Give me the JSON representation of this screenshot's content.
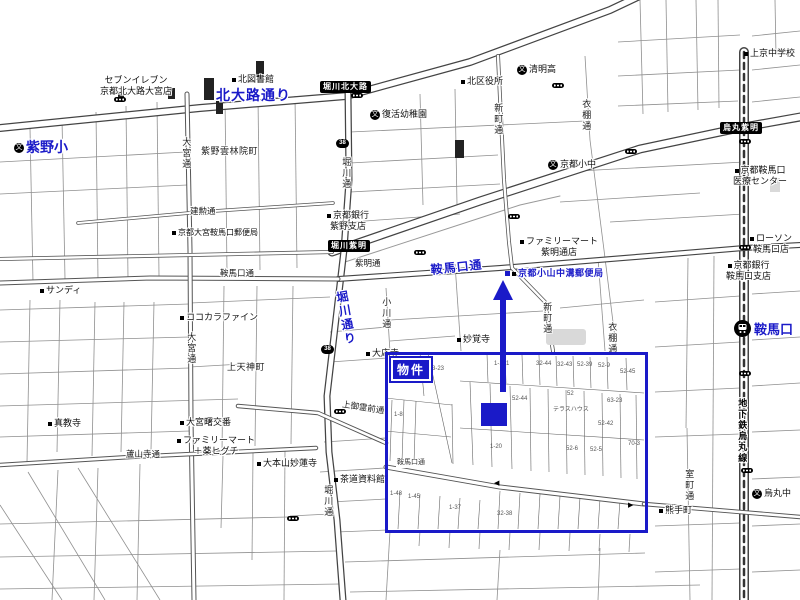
{
  "map": {
    "accent": "#1a1ac8",
    "property": {
      "label": "物件"
    },
    "icon_glyphs": {
      "school": "文"
    },
    "shields": [
      {
        "x": 336,
        "y": 139,
        "label": "38"
      },
      {
        "x": 321,
        "y": 345,
        "label": "38"
      }
    ],
    "signals": [
      [
        114,
        97
      ],
      [
        351,
        93
      ],
      [
        552,
        83
      ],
      [
        625,
        149
      ],
      [
        739,
        139
      ],
      [
        508,
        214
      ],
      [
        414,
        250
      ],
      [
        739,
        245
      ],
      [
        334,
        409
      ],
      [
        739,
        371
      ],
      [
        741,
        468
      ],
      [
        287,
        516
      ]
    ],
    "labels": [
      {
        "id": "kitaoji-dori-label",
        "c": "bstreet",
        "x": 216,
        "y": 87,
        "t": "北大路通り"
      },
      {
        "id": "horikawa-dori-label",
        "c": "bstreet vert",
        "x": 333,
        "y": 292,
        "t": "堀川通り",
        "fs": 12,
        "r": -10
      },
      {
        "id": "kuramaguchi-dori-blue-label",
        "c": "bstreet",
        "x": 430,
        "y": 263,
        "t": "鞍馬口通",
        "fs": 12,
        "r": -6
      },
      {
        "id": "murasakino-elementary-label",
        "c": "bname",
        "x": 14,
        "y": 139,
        "t": "紫野小",
        "i": [
          "school"
        ]
      },
      {
        "id": "kuramaguchi-station-label",
        "c": "bname",
        "x": 754,
        "y": 322,
        "t": "鞍馬口",
        "fs": 13
      },
      {
        "id": "koyama-nakamizo-post-office-label",
        "c": "bpoi",
        "x": 505,
        "y": 268,
        "t": "京都小山中溝郵便局",
        "i": [
          "bluesq",
          "dot"
        ]
      },
      {
        "id": "horikawa-kitaoji-box",
        "c": "ibox",
        "x": 320,
        "y": 81,
        "t": "堀川北大路"
      },
      {
        "id": "horikawa-shimei-box",
        "c": "ibox",
        "x": 328,
        "y": 240,
        "t": "堀川紫明"
      },
      {
        "id": "karasuma-shimei-box",
        "c": "ibox",
        "x": 720,
        "y": 122,
        "t": "烏丸紫明"
      },
      {
        "id": "seven-eleven-label",
        "c": "poi ctr",
        "x": 100,
        "y": 75,
        "t": "セブンイレブン\n京都北大路大宮店"
      },
      {
        "id": "kita-library-label",
        "c": "poi",
        "x": 232,
        "y": 74,
        "t": "北図書館",
        "i": [
          "dot"
        ]
      },
      {
        "id": "fukkatsu-kindergarten-label",
        "c": "poi",
        "x": 370,
        "y": 109,
        "t": "復活幼稚園",
        "i": [
          "school"
        ]
      },
      {
        "id": "kita-ward-office-label",
        "c": "poi",
        "x": 461,
        "y": 76,
        "t": "北区役所",
        "i": [
          "dot"
        ]
      },
      {
        "id": "seimei-high-label",
        "c": "poi",
        "x": 517,
        "y": 64,
        "t": "清明高",
        "i": [
          "school"
        ]
      },
      {
        "id": "murasakino-unrinin-cho-label",
        "c": "town",
        "x": 201,
        "y": 146,
        "t": "紫野雲林院町"
      },
      {
        "id": "kyoto-shochu-label",
        "c": "poi",
        "x": 548,
        "y": 159,
        "t": "京都小中",
        "i": [
          "school"
        ]
      },
      {
        "id": "kamigyo-jhs-label",
        "c": "poi",
        "x": 744,
        "y": 48,
        "t": "上京中学校",
        "i": [
          "dot"
        ]
      },
      {
        "id": "kuramaguchi-medical-center-label",
        "c": "poi ctr",
        "x": 733,
        "y": 165,
        "t": "京都鞍馬口\n医療センター",
        "i": [
          "dot"
        ]
      },
      {
        "id": "lawson-kuramaguchi-label",
        "c": "poi ctr",
        "x": 750,
        "y": 233,
        "t": "ローソン\n鞍馬口店",
        "i": [
          "dot"
        ]
      },
      {
        "id": "kyoto-bank-murasakino-label",
        "c": "poi ctr",
        "x": 327,
        "y": 210,
        "t": "京都銀行\n紫野支店",
        "i": [
          "dot"
        ]
      },
      {
        "id": "kyoto-bank-kuramaguchi-label",
        "c": "poi ctr",
        "x": 726,
        "y": 260,
        "t": "京都銀行\n鞍馬口支店",
        "i": [
          "dot"
        ]
      },
      {
        "id": "familymart-shimei-label",
        "c": "poi ctr",
        "x": 520,
        "y": 236,
        "t": "ファミリーマート\n紫明通店",
        "i": [
          "dot"
        ]
      },
      {
        "id": "kenkun-dori-label",
        "c": "street",
        "x": 190,
        "y": 206,
        "t": "建勲通"
      },
      {
        "id": "omiya-kuramaguchi-post-office-label",
        "c": "poi",
        "x": 172,
        "y": 228,
        "t": "京都大宮鞍馬口郵便局",
        "i": [
          "dot"
        ],
        "fs": 8
      },
      {
        "id": "shimei-dori-label",
        "c": "street",
        "x": 355,
        "y": 258,
        "t": "紫明通"
      },
      {
        "id": "sandy-label",
        "c": "poi",
        "x": 40,
        "y": 285,
        "t": "サンディ",
        "i": [
          "dot"
        ]
      },
      {
        "id": "cocokara-fine-label",
        "c": "poi",
        "x": 180,
        "y": 312,
        "t": "ココカラファイン",
        "i": [
          "dot"
        ]
      },
      {
        "id": "kuramaguchi-dori-west-label",
        "c": "street",
        "x": 220,
        "y": 268,
        "t": "鞍馬口通"
      },
      {
        "id": "kamitenjin-cho-label",
        "c": "town",
        "x": 227,
        "y": 362,
        "t": "上天神町"
      },
      {
        "id": "shinkyoji-label",
        "c": "poi",
        "x": 48,
        "y": 418,
        "t": "真教寺",
        "i": [
          "dot"
        ]
      },
      {
        "id": "omiya-koban-label",
        "c": "poi",
        "x": 180,
        "y": 417,
        "t": "大宮曙交番",
        "i": [
          "dot"
        ]
      },
      {
        "id": "familymart-higuchi-label",
        "c": "poi ctr",
        "x": 177,
        "y": 435,
        "t": "ファミリーマート\n＋薬ヒグチ",
        "i": [
          "dot"
        ]
      },
      {
        "id": "rozanji-dori-label",
        "c": "street",
        "x": 126,
        "y": 449,
        "t": "蘆山寺通"
      },
      {
        "id": "myorenji-label",
        "c": "poi",
        "x": 257,
        "y": 458,
        "t": "大本山妙蓮寺",
        "i": [
          "dot"
        ]
      },
      {
        "id": "kamigoryo-mae-dori-label",
        "c": "street",
        "x": 343,
        "y": 399,
        "t": "上御霊前通",
        "r": 9
      },
      {
        "id": "sado-museum-label",
        "c": "poi",
        "x": 334,
        "y": 474,
        "t": "茶道資料館",
        "i": [
          "dot"
        ]
      },
      {
        "id": "myokakuji-label",
        "c": "poi",
        "x": 457,
        "y": 334,
        "t": "妙覚寺",
        "i": [
          "dot"
        ]
      },
      {
        "id": "daioji-label",
        "c": "poi",
        "x": 366,
        "y": 348,
        "t": "大応寺",
        "i": [
          "dot"
        ]
      },
      {
        "id": "kumade-cho-label",
        "c": "poi",
        "x": 659,
        "y": 505,
        "t": "熊手町",
        "i": [
          "dot"
        ]
      },
      {
        "id": "karasuma-chu-label",
        "c": "poi",
        "x": 752,
        "y": 488,
        "t": "烏丸中",
        "i": [
          "school"
        ]
      },
      {
        "id": "omiya-dori-north-label",
        "c": "vstreet",
        "x": 180,
        "y": 137,
        "t": "大宮通"
      },
      {
        "id": "horikawa-dori-north-label",
        "c": "vstreet",
        "x": 340,
        "y": 157,
        "t": "堀川通"
      },
      {
        "id": "shinmachi-dori-north-label",
        "c": "vstreet",
        "x": 492,
        "y": 103,
        "t": "新町通"
      },
      {
        "id": "koromonotana-dori-north-label",
        "c": "vstreet",
        "x": 580,
        "y": 99,
        "t": "衣棚通"
      },
      {
        "id": "omiya-dori-south-label",
        "c": "vstreet",
        "x": 185,
        "y": 332,
        "t": "大宮通"
      },
      {
        "id": "ogawa-dori-label",
        "c": "vstreet",
        "x": 380,
        "y": 297,
        "t": "小川通"
      },
      {
        "id": "shinmachi-dori-south-label",
        "c": "vstreet",
        "x": 541,
        "y": 302,
        "t": "新町通"
      },
      {
        "id": "koromonotana-dori-south-label",
        "c": "vstreet",
        "x": 606,
        "y": 322,
        "t": "衣棚通"
      },
      {
        "id": "horikawa-dori-south-label",
        "c": "vstreet",
        "x": 322,
        "y": 485,
        "t": "堀川通"
      },
      {
        "id": "muromachi-dori-label",
        "c": "vstreet",
        "x": 683,
        "y": 469,
        "t": "室町通"
      },
      {
        "id": "karasuma-subway-line-label",
        "c": "vstreet dark",
        "x": 736,
        "y": 398,
        "t": "地下鉄烏丸線"
      },
      {
        "id": "kuramaguchi-dori-rect-label",
        "c": "tinystreet",
        "x": 396,
        "y": 459,
        "t": "鞍馬口通"
      },
      {
        "id": "parcel-number",
        "c": "tiny",
        "x": 432,
        "y": 366,
        "t": "3-23"
      },
      {
        "id": "parcel-number",
        "c": "tiny",
        "x": 394,
        "y": 412,
        "t": "1-8"
      },
      {
        "id": "parcel-number",
        "c": "tiny",
        "x": 494,
        "y": 361,
        "t": "1-101"
      },
      {
        "id": "parcel-number",
        "c": "tiny",
        "x": 536,
        "y": 361,
        "t": "32-44"
      },
      {
        "id": "parcel-number",
        "c": "tiny",
        "x": 557,
        "y": 362,
        "t": "32-43"
      },
      {
        "id": "parcel-number",
        "c": "tiny",
        "x": 577,
        "y": 362,
        "t": "52-39"
      },
      {
        "id": "parcel-number",
        "c": "tiny",
        "x": 598,
        "y": 363,
        "t": "52-9"
      },
      {
        "id": "parcel-number",
        "c": "tiny",
        "x": 620,
        "y": 369,
        "t": "52-45"
      },
      {
        "id": "parcel-number",
        "c": "tiny",
        "x": 512,
        "y": 396,
        "t": "52-44"
      },
      {
        "id": "parcel-number",
        "c": "tiny",
        "x": 567,
        "y": 391,
        "t": "52"
      },
      {
        "id": "parcel-number",
        "c": "tiny",
        "x": 607,
        "y": 398,
        "t": "63-23"
      },
      {
        "id": "parcel-name",
        "c": "tiny",
        "x": 553,
        "y": 407,
        "t": "テラスハウス"
      },
      {
        "id": "parcel-number",
        "c": "tiny",
        "x": 598,
        "y": 421,
        "t": "52-42"
      },
      {
        "id": "parcel-number",
        "c": "tiny",
        "x": 490,
        "y": 444,
        "t": "1-20"
      },
      {
        "id": "parcel-number",
        "c": "tiny",
        "x": 566,
        "y": 446,
        "t": "52-6"
      },
      {
        "id": "parcel-number",
        "c": "tiny",
        "x": 590,
        "y": 447,
        "t": "52-5"
      },
      {
        "id": "parcel-number",
        "c": "tiny",
        "x": 628,
        "y": 441,
        "t": "70-3"
      },
      {
        "id": "parcel-number",
        "c": "tiny",
        "x": 390,
        "y": 491,
        "t": "1-48"
      },
      {
        "id": "parcel-number",
        "c": "tiny",
        "x": 408,
        "y": 494,
        "t": "1-45"
      },
      {
        "id": "parcel-number",
        "c": "tiny",
        "x": 449,
        "y": 505,
        "t": "1-37"
      },
      {
        "id": "parcel-number",
        "c": "tiny",
        "x": 497,
        "y": 511,
        "t": "32-38"
      },
      {
        "id": "oneway-arrow",
        "c": "oneway",
        "x": 494,
        "y": 480,
        "t": "◀"
      },
      {
        "id": "oneway-arrow",
        "c": "oneway",
        "x": 628,
        "y": 502,
        "t": "▶"
      }
    ]
  }
}
